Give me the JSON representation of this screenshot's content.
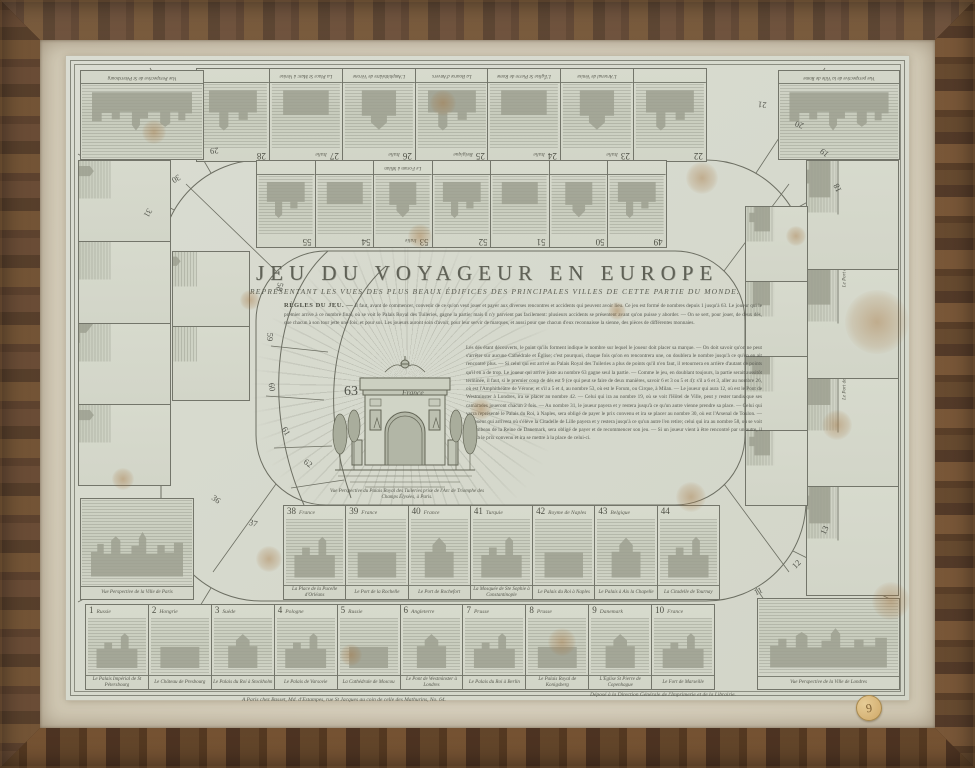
{
  "artwork": {
    "title": "JEU DU VOYAGEUR EN EUROPE",
    "subtitle": "REPRÉSENTANT LES VUES DES PLUS BEAUX ÉDIFICES DES PRINCIPALES VILLES DE CETTE PARTIE DU MONDE.",
    "rules_heading": "RÈGLES DU JEU. —",
    "rules_intro": "Il faut, avant de commencer, convenir de ce qu'on veut jouer et payer aux diverses rencontres et accidents qui peuvent avoir lieu. Ce jeu est formé de nombres depuis 1 jusqu'à 63. Le joueur qui le premier arrive à ce nombre final, où se voit le Palais Royal des Tuileries, gagne la partie; mais il n'y parvient pas facilement: plusieurs accidents se présentent avant qu'on puisse y aborder. — On se sert, pour jouer, de deux dés, que chacun à son tour jette une fois, et pour soi. Les joueurs auront soin d'avoir, pour leur servir de marques, et aussi pour que chacun d'eux reconnaisse la sienne, des pièces de différentes monnaies.",
    "rules_column": "Les dés étant découverts, le point qu'ils forment indique le nombre sur lequel le joueur doit placer sa marque. — On doit savoir qu'on ne peut s'arrêter sur aucune Cathédrale et Église; c'est pourquoi, chaque fois qu'on en rencontrera une, on doublera le nombre jusqu'à ce qu'on en ait rencontré plus. — Si celui qui est arrivé au Palais Royal des Tuileries a plus de points qu'il n'en faut, il retournera en arrière d'autant de points qu'il en a de trop. Le joueur qui arrive juste au nombre 63 gagne seul la partie. — Comme le jeu, en doublant toujours, la partie serait aussitôt terminée, il faut, si le premier coup de dés est 9 (ce qui peut se faire de deux manières, savoir 6 et 3 ou 5 et 4): s'il a 6 et 3, aller au nombre 26, où est l'Amphithéâtre de Vérone; et s'il a 5 et 4, au nombre 53, où est le Forum, ou Cirque, à Milan. — Le joueur qui aura 12, où est le Pont de Westminster à Londres, ira se placer au nombre 42. — Celui qui ira au nombre 19, où se voit l'Hôtel de Ville, peut y rester tandis que ses camarades joueront chacun 2 fois. — Au nombre 31, le joueur payera et y restera jusqu'à ce qu'un autre vienne prendre sa place. — Celui qui verra représenté le Palais du Roi, à Naples, sera obligé de payer le prix convenu et ira se placer au nombre 30, où est l'Arsenal de Toulon. — Le joueur qui arrivera où s'élève la Citadelle de Lille payera et y restera jusqu'à ce qu'un autre l'en retire; celui qui ira au nombre 58, où se voit le Tombeau de la Reine de Danemark, sera obligé de payer et de recommencer son jeu. — Si un joueur vient à être rencontré par un autre, il payera le prix convenu et ira se mettre à la place de celui-ci.",
    "imprint_left": "A Paris chez Basset, Md. d'Estampes, rue St Jacques au coin de celle des Mathurins, No. 64.",
    "imprint_right": "Déposé à la Direction Générale de l'Imprimerie et de la Librairie.",
    "colors": {
      "frame_wood": "#53351c",
      "mat_paper": "#d7d0be",
      "print_paper": "#d9dcd1",
      "ink": "#565850",
      "foxing": "#a97f4f",
      "sticker": "#d9bc85"
    }
  },
  "center": {
    "num": "63",
    "country": "France",
    "caption": "Vue Perspective du Palais Royal des Tuileries prise de l'Arc de Triomphe des Champs Élysées, à Paris."
  },
  "corners": {
    "tl": {
      "caption": "Vue Perspective de St Pétersbourg"
    },
    "tr": {
      "caption": "Vue perspective de la Ville de Rome"
    },
    "br": {
      "caption": "Vue Perspective de la Ville de Londres"
    },
    "bl": {
      "caption": "Vue Perspective de la Ville de Paris"
    }
  },
  "board": {
    "bottom_outer": [
      {
        "num": "1",
        "country": "Russie",
        "caption": "Le Palais Impérial de St Pétersbourg"
      },
      {
        "num": "2",
        "country": "Hongrie",
        "caption": "Le Château de Presbourg"
      },
      {
        "num": "3",
        "country": "Suède",
        "caption": "Le Palais du Roi à Stockholm"
      },
      {
        "num": "4",
        "country": "Pologne",
        "caption": "Le Palais de Varsovie"
      },
      {
        "num": "5",
        "country": "Russie",
        "caption": "La Cathédrale de Moscou"
      },
      {
        "num": "6",
        "country": "Angleterre",
        "caption": "Le Pont de Westminster à Londres"
      },
      {
        "num": "7",
        "country": "Prusse",
        "caption": "Le Palais du Roi à Berlin"
      },
      {
        "num": "8",
        "country": "Prusse",
        "caption": "Le Palais Royal de Konigsberg"
      },
      {
        "num": "9",
        "country": "Danemark",
        "caption": "L'Église St Pierre de Copenhague"
      },
      {
        "num": "10",
        "country": "France",
        "caption": "Le Fort de Marseille"
      }
    ],
    "bottom_inner": [
      {
        "num": "38",
        "country": "France",
        "caption": "La Place de la Pucelle d'Orléans"
      },
      {
        "num": "39",
        "country": "France",
        "caption": "Le Port de la Rochelle"
      },
      {
        "num": "40",
        "country": "France",
        "caption": "Le Port de Rochefort"
      },
      {
        "num": "41",
        "country": "Turquie",
        "caption": "La Mosquée de Ste Sophie à Constantinople"
      },
      {
        "num": "42",
        "country": "Royme de Naples",
        "caption": "Le Palais du Roi à Naples"
      },
      {
        "num": "43",
        "country": "Belgique",
        "caption": "Le Palais à Aix la Chapelle"
      },
      {
        "num": "44",
        "country": "",
        "caption": "La Citadelle de Tournay"
      }
    ],
    "top_outer": [
      {
        "num": "28",
        "country": "",
        "caption": ""
      },
      {
        "num": "27",
        "country": "Italie",
        "caption": "La Place St Marc à Venise"
      },
      {
        "num": "26",
        "country": "Italie",
        "caption": "L'Amphithéâtre de Vérone"
      },
      {
        "num": "25",
        "country": "Belgique",
        "caption": "La Bourse d'Anvers"
      },
      {
        "num": "24",
        "country": "Italie",
        "caption": "L'Église St Pierre de Rome"
      },
      {
        "num": "23",
        "country": "Italie",
        "caption": "L'Arsenal de Venise"
      },
      {
        "num": "22",
        "country": "",
        "caption": ""
      }
    ],
    "top_inner": [
      {
        "num": "55",
        "country": "",
        "caption": ""
      },
      {
        "num": "54",
        "country": "",
        "caption": ""
      },
      {
        "num": "53",
        "country": "Italie",
        "caption": "Le Forum à Milan"
      },
      {
        "num": "52",
        "country": "",
        "caption": ""
      },
      {
        "num": "51",
        "country": "",
        "caption": ""
      },
      {
        "num": "50",
        "country": "",
        "caption": ""
      },
      {
        "num": "49",
        "country": "",
        "caption": ""
      }
    ],
    "right_outer": [
      {
        "num": "17",
        "country": "Portugal",
        "caption": ""
      },
      {
        "num": "16",
        "country": "Espagne",
        "caption": "Le Port de Cadix"
      },
      {
        "num": "15",
        "country": "France",
        "caption": "Le Port de Bordeaux"
      },
      {
        "num": "14",
        "country": "France",
        "caption": ""
      }
    ],
    "right_inner": [
      {
        "num": "48",
        "country": "",
        "caption": ""
      },
      {
        "num": "47",
        "country": "",
        "caption": ""
      },
      {
        "num": "46",
        "country": "",
        "caption": ""
      },
      {
        "num": "45",
        "country": "",
        "caption": ""
      }
    ],
    "left_outer": [
      {
        "num": "32",
        "country": "",
        "caption": ""
      },
      {
        "num": "33",
        "country": "France",
        "caption": ""
      },
      {
        "num": "34",
        "country": "France",
        "caption": ""
      },
      {
        "num": "35",
        "country": "France",
        "caption": ""
      }
    ],
    "left_inner": [
      {
        "num": "56",
        "country": "",
        "caption": ""
      },
      {
        "num": "57",
        "country": "",
        "caption": ""
      }
    ],
    "curve_numbers": {
      "n11": "11",
      "n12": "12",
      "n13": "13",
      "n18": "18",
      "n19": "19",
      "n20": "20",
      "n21": "21",
      "n29": "29",
      "n30": "30",
      "n31": "31",
      "n36": "36",
      "n37": "37",
      "n58": "58",
      "n59": "59",
      "n60": "60",
      "n61": "61",
      "n62": "62"
    }
  },
  "sticker_label": "9"
}
